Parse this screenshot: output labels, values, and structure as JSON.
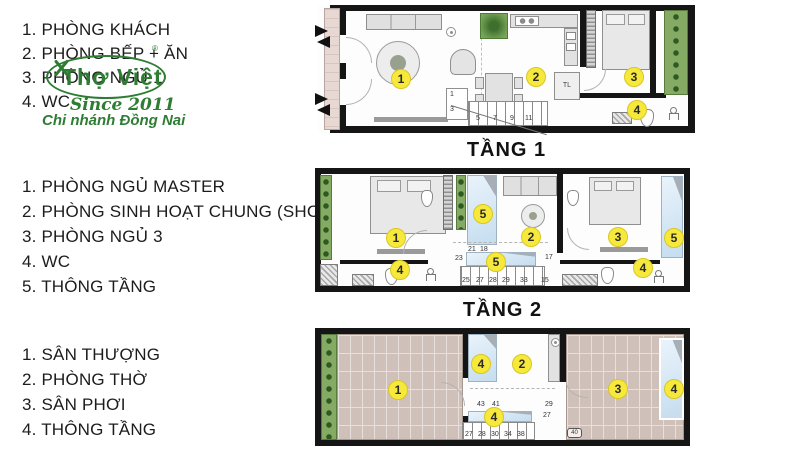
{
  "logo": {
    "name": "Thợ Việt",
    "reg": "®",
    "since": "Since 2011",
    "branch": "Chi nhánh Đồng Nai",
    "color": "#2e7d33"
  },
  "legend_floor1": {
    "items": [
      "1. PHÒNG KHÁCH",
      "2. PHÒNG BẾP + ĂN",
      "3. PHÒNG NGỦ 1",
      "4. WC"
    ]
  },
  "legend_floor2": {
    "items": [
      "1. PHÒNG NGỦ MASTER",
      "2. PHÒNG SINH HOẠT CHUNG (SHC)",
      "3. PHÒNG NGỦ 3",
      "4. WC",
      "5. THÔNG TẦNG"
    ]
  },
  "legend_floor3": {
    "items": [
      "1. SÂN THƯỢNG",
      "2. PHÒNG THỜ",
      "3. SÂN PHƠI",
      "4. THÔNG TẦNG"
    ]
  },
  "floor1": {
    "label": "TẦNG 1",
    "badges": {
      "living": "1",
      "dining": "2",
      "bedroom": "3",
      "wc": "4"
    },
    "stairs": [
      "1",
      "3",
      "5",
      "7",
      "9",
      "11"
    ],
    "fridge": "TL"
  },
  "floor2": {
    "label": "TẦNG 2",
    "badges": {
      "master": "1",
      "shc": "2",
      "bedroom3": "3",
      "wc_left": "4",
      "wc_right": "4",
      "void_top": "5",
      "void_stair": "5",
      "void_right": "5"
    },
    "stairs_top": [
      "21",
      "18"
    ],
    "stairs_side": [
      "23",
      "17"
    ],
    "stairs_bottom": [
      "25",
      "27",
      "28",
      "29",
      "33",
      "15"
    ]
  },
  "floor3": {
    "badges": {
      "terrace": "1",
      "altar": "2",
      "laundry": "3",
      "void_mid": "4",
      "void_stair": "4",
      "void_right": "4"
    },
    "stairs_top": [
      "43",
      "41"
    ],
    "stairs_side": [
      "29",
      "27"
    ],
    "stairs_bottom": [
      "27",
      "28",
      "30",
      "34",
      "38"
    ],
    "corner_tag": "40"
  },
  "colors": {
    "badge_yellow": "#f6e93c",
    "void_blue": "#cfe2f2",
    "planter_green": "#84aa63",
    "brick": "#cfc0ba",
    "wall": "#151515",
    "logo_green": "#2e7d33"
  }
}
